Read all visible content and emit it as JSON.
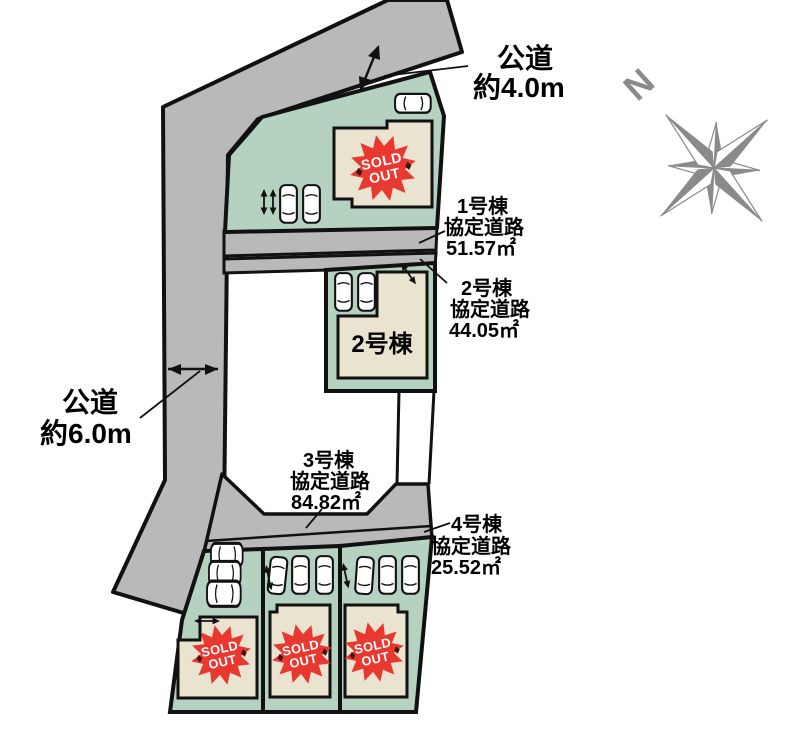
{
  "plan_type": "residential-site-plan",
  "roads": {
    "public_road_top": {
      "line1": "公道",
      "line2": "約4.0m"
    },
    "public_road_left": {
      "line1": "公道",
      "line2": "約6.0m"
    }
  },
  "annotations": [
    {
      "building": "1号棟",
      "road": "協定道路",
      "area": "51.57㎡"
    },
    {
      "building": "2号棟",
      "road": "協定道路",
      "area": "44.05㎡"
    },
    {
      "building": "3号棟",
      "road": "協定道路",
      "area": "84.82㎡"
    },
    {
      "building": "4号棟",
      "road": "協定道路",
      "area": "25.52㎡"
    }
  ],
  "buildings": {
    "unit2_label": "2号棟"
  },
  "sold_out_badge": {
    "line1": "SOLD",
    "line2": "OUT"
  },
  "compass": {
    "north": "N"
  },
  "colors": {
    "road_gray": "#b9b9b9",
    "lot_green": "#b5d1c0",
    "building_beige": "#eae3d0",
    "sold_out_red": "#e8382f",
    "outline_black": "#111111",
    "compass_gray": "#8a8a8a"
  }
}
